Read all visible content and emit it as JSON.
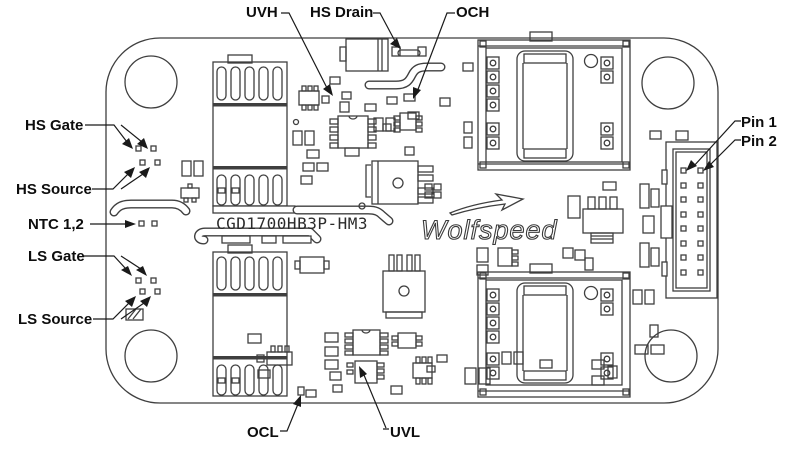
{
  "figure": {
    "type": "pcb-component-location-diagram",
    "background": "#ffffff",
    "line_color": "#3f3f3f",
    "label_color": "#0d0d0d"
  },
  "board": {
    "part_number": "CGD1700HB3P-HM3",
    "brand": "Wolfspeed"
  },
  "callouts": {
    "uvh": "UVH",
    "hs_drain": "HS Drain",
    "och": "OCH",
    "hs_gate": "HS Gate",
    "hs_source": "HS Source",
    "ntc": "NTC 1,2",
    "ls_gate": "LS Gate",
    "ls_source": "LS Source",
    "ocl": "OCL",
    "uvl": "UVL",
    "pin1": "Pin 1",
    "pin2": "Pin 2"
  },
  "connector": {
    "pin_columns": 2,
    "pin_rows": 8,
    "total_pins": 16
  }
}
